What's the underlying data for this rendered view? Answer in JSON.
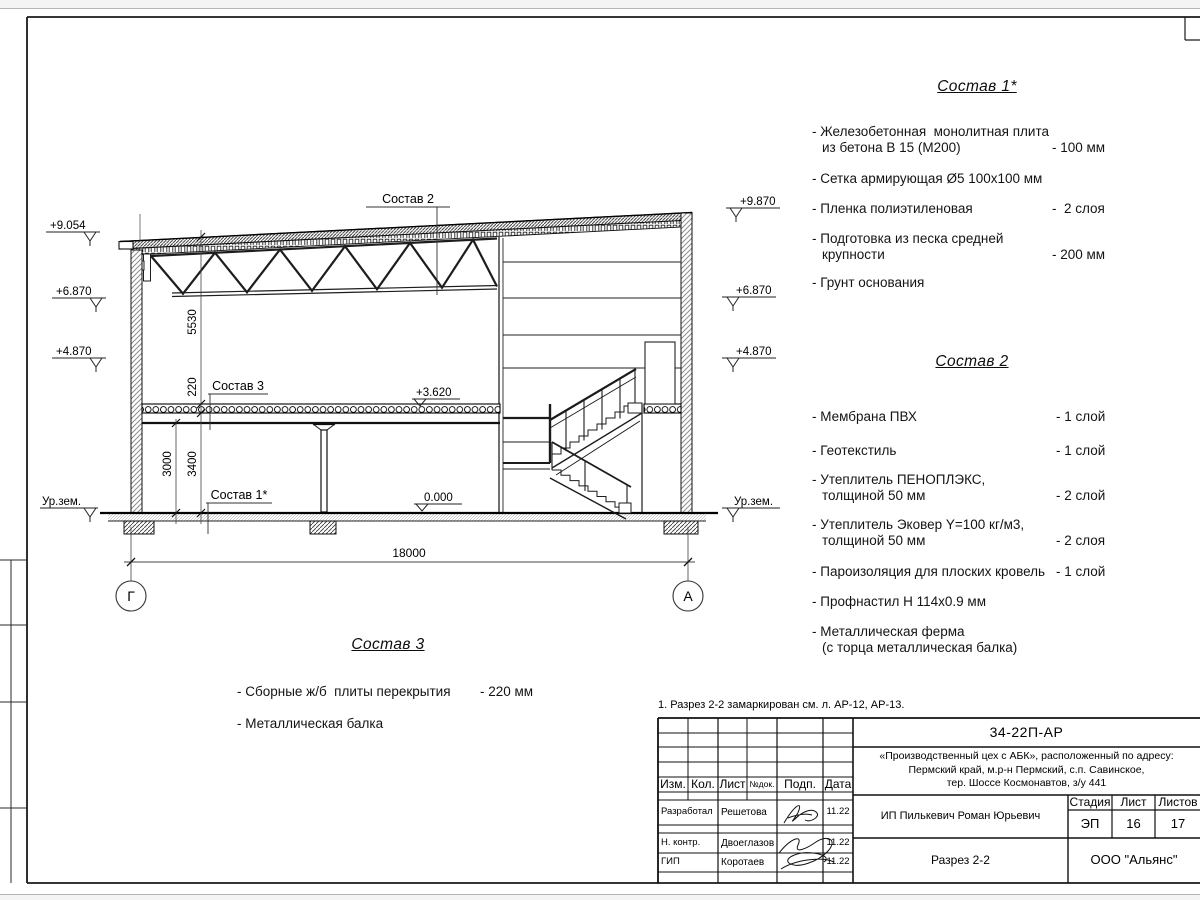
{
  "page": {
    "note": "1. Разрез 2-2 замаркирован см. л. АР-12, АР-13."
  },
  "compositions": [
    {
      "title": "Состав 1*",
      "items": [
        {
          "lines": [
            "- Железобетонная  монолитная плита",
            "из бетона В 15 (М200)"
          ],
          "value": "- 100 мм"
        },
        {
          "lines": [
            "- Сетка армирующая Ø5 100х100 мм"
          ],
          "value": ""
        },
        {
          "lines": [
            "- Пленка полиэтиленовая"
          ],
          "value": "-  2 слоя"
        },
        {
          "lines": [
            "- Подготовка из песка средней",
            "крупности"
          ],
          "value": "- 200 мм"
        },
        {
          "lines": [
            "- Грунт основания"
          ],
          "value": ""
        }
      ]
    },
    {
      "title": "Состав 2",
      "items": [
        {
          "lines": [
            "- Мембрана ПВХ"
          ],
          "value": "- 1 слой"
        },
        {
          "lines": [
            "- Геотекстиль"
          ],
          "value": "- 1 слой"
        },
        {
          "lines": [
            "- Утеплитель ПЕНОПЛЭКС,",
            "толщиной 50 мм"
          ],
          "value": "- 2 слой"
        },
        {
          "lines": [
            "- Утеплитель Эковер Y=100 кг/м3,",
            "толщиной 50 мм"
          ],
          "value": "- 2 слоя"
        },
        {
          "lines": [
            "- Пароизоляция для плоских кровель"
          ],
          "value": "- 1 слой"
        },
        {
          "lines": [
            "- Профнастил Н 114х0.9 мм"
          ],
          "value": ""
        },
        {
          "lines": [
            "- Металлическая ферма",
            "(с торца металлическая балка)"
          ],
          "value": ""
        }
      ]
    },
    {
      "title": "Состав 3",
      "items": [
        {
          "lines": [
            "- Сборные ж/б  плиты перекрытия"
          ],
          "value": "- 220 мм"
        },
        {
          "lines": [
            "- Металлическая балка"
          ],
          "value": ""
        }
      ]
    }
  ],
  "drawing": {
    "elev_left": [
      "+9.054",
      "+6.870",
      "+4.870",
      "Ур.зем."
    ],
    "elev_right": [
      "+9.870",
      "+6.870",
      "+4.870",
      "Ур.зем."
    ],
    "mark_floor": "+3.620",
    "mark_zero": "0.000",
    "dim_span": "18000",
    "dim_truss_h": "5530",
    "dim_slab": "220",
    "dim_h1": "3000",
    "dim_h2": "3400",
    "axis_left": "Г",
    "axis_right": "А",
    "label_s1": "Состав 1*",
    "label_s2": "Состав 2",
    "label_s3": "Состав 3"
  },
  "titleblock": {
    "doc_number": "34-22П-АР",
    "project": [
      "«Производственный цех с АБК», расположенный по адресу:",
      "Пермский край, м.р-н Пермский, с.п. Савинское,",
      "тер. Шоссе Космонавтов, з/у 441"
    ],
    "columns": {
      "izm": "Изм.",
      "kol": "Кол.",
      "list": "Лист",
      "ndoc": "№док.",
      "podp": "Подп.",
      "data": "Дата"
    },
    "rows": [
      {
        "role": "Разработал",
        "name": "Решетова",
        "date": "11.22"
      },
      {
        "role": "Н. контр.",
        "name": "Двоеглазов",
        "date": "11.22"
      },
      {
        "role": "ГИП",
        "name": "Коротаев",
        "date": "11.22"
      }
    ],
    "client": "ИП Пилькевич Роман Юрьевич",
    "stage_label": "Стадия",
    "sheet_label": "Лист",
    "sheets_label": "Листов",
    "stage": "ЭП",
    "sheet_no": "16",
    "sheets_total": "17",
    "drawing_title": "Разрез 2-2",
    "company": "ООО \"Альянс\""
  }
}
